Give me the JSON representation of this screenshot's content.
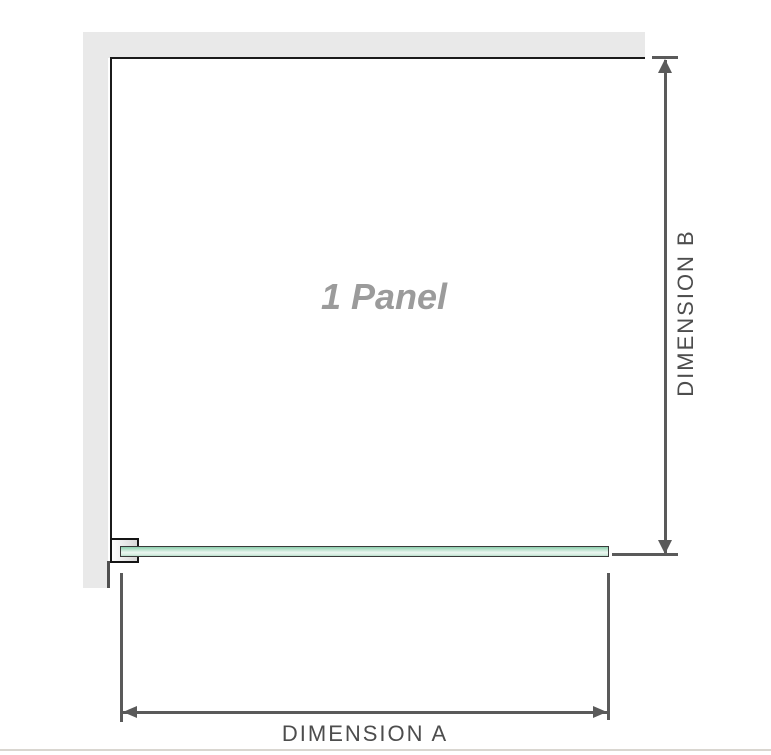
{
  "diagram": {
    "panel_label": "1 Panel",
    "dimensions": {
      "a_label": "DIMENSION A",
      "b_label": "DIMENSION B"
    },
    "colors": {
      "wall": "#e9e9e9",
      "panel_border": "#1b1b1b",
      "bracket_border": "#151515",
      "bracket_fill_light": "#fdfdfd",
      "bracket_fill_dark": "#d8d8d8",
      "glass_border": "#3a3a3a",
      "glass_green_top": "#8ccfae",
      "glass_green_light": "#ecf7f1",
      "glass_green_bottom": "#b3dec8",
      "dim_line": "#5a5a5a",
      "dim_text": "#4d4d4d",
      "panel_text": "#9b9b9b",
      "wall_edge": "#4f4f4f",
      "bottom_rule": "#d9d6d0"
    }
  }
}
